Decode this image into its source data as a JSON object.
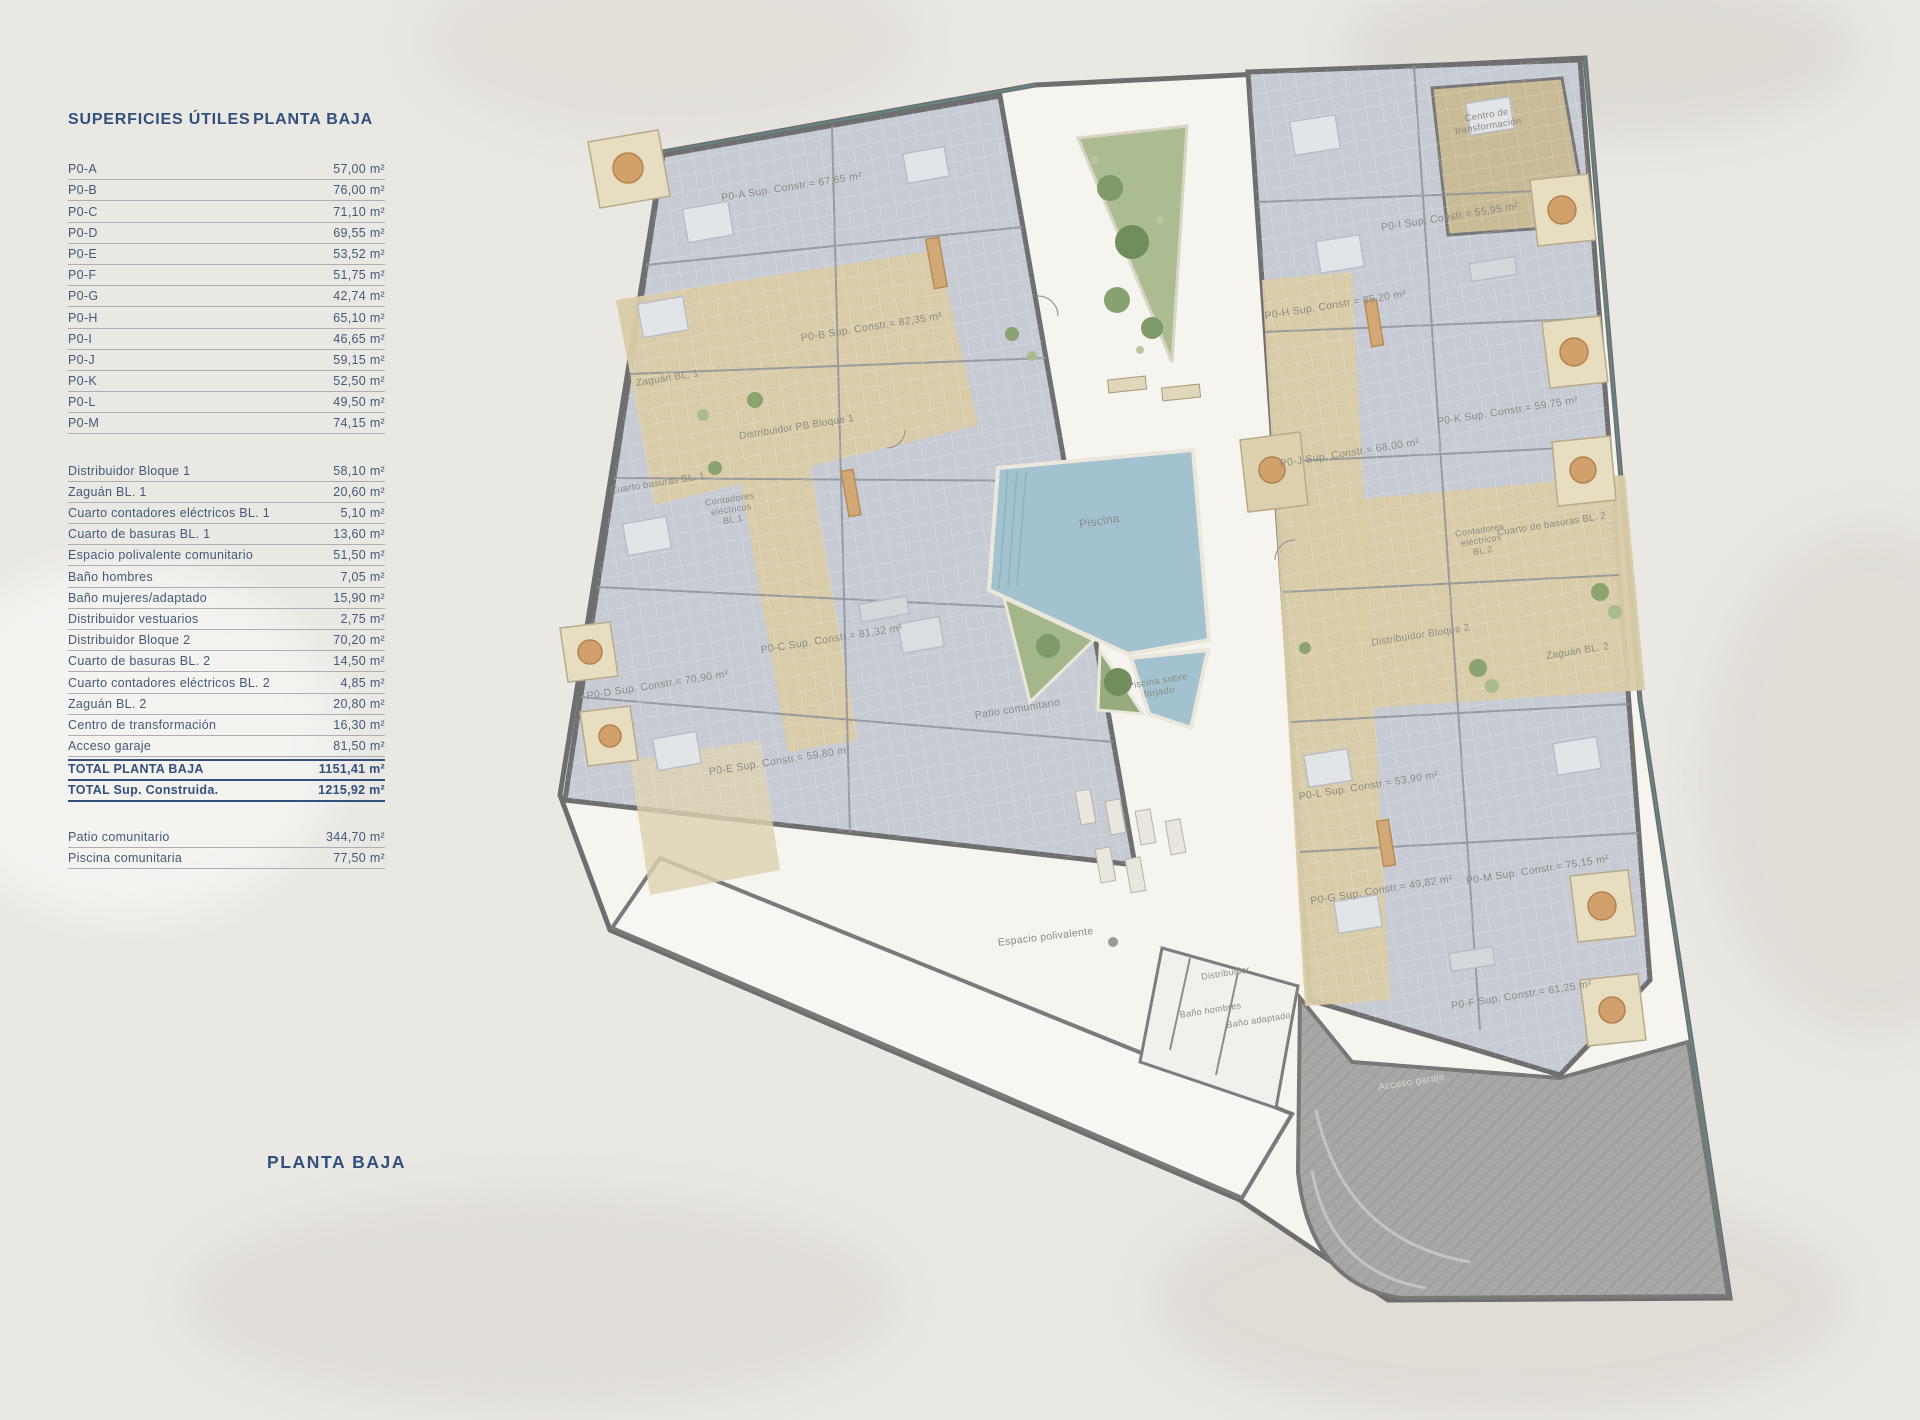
{
  "surface_table": {
    "title": "SUPERFICIES ÚTILES",
    "subtitle": "PLANTA BAJA",
    "apartments": [
      {
        "label": "P0-A",
        "value": "57,00 m²"
      },
      {
        "label": "P0-B",
        "value": "76,00 m²"
      },
      {
        "label": "P0-C",
        "value": "71,10 m²"
      },
      {
        "label": "P0-D",
        "value": "69,55 m²"
      },
      {
        "label": "P0-E",
        "value": "53,52 m²"
      },
      {
        "label": "P0-F",
        "value": "51,75 m²"
      },
      {
        "label": "P0-G",
        "value": "42,74 m²"
      },
      {
        "label": "P0-H",
        "value": "65,10 m²"
      },
      {
        "label": "P0-I",
        "value": "46,65 m²"
      },
      {
        "label": "P0-J",
        "value": "59,15 m²"
      },
      {
        "label": "P0-K",
        "value": "52,50 m²"
      },
      {
        "label": "P0-L",
        "value": "49,50 m²"
      },
      {
        "label": "P0-M",
        "value": "74,15 m²"
      }
    ],
    "common_rows": [
      {
        "label": "Distribuidor Bloque 1",
        "value": "58,10 m²"
      },
      {
        "label": "Zaguán BL. 1",
        "value": "20,60 m²"
      },
      {
        "label": "Cuarto contadores eléctricos BL. 1",
        "value": "5,10 m²"
      },
      {
        "label": "Cuarto de basuras BL. 1",
        "value": "13,60 m²"
      },
      {
        "label": "Espacio polivalente comunitario",
        "value": "51,50 m²"
      },
      {
        "label": "Baño hombres",
        "value": "7,05 m²"
      },
      {
        "label": "Baño mujeres/adaptado",
        "value": "15,90 m²"
      },
      {
        "label": "Distribuidor vestuarios",
        "value": "2,75 m²"
      },
      {
        "label": "Distribuidor Bloque 2",
        "value": "70,20 m²"
      },
      {
        "label": "Cuarto de basuras BL. 2",
        "value": "14,50 m²"
      },
      {
        "label": "Cuarto contadores eléctricos BL. 2",
        "value": "4,85 m²"
      },
      {
        "label": "Zaguán BL. 2",
        "value": "20,80 m²"
      },
      {
        "label": "Centro de transformación",
        "value": "16,30 m²"
      },
      {
        "label": "Acceso garaje",
        "value": "81,50 m²"
      }
    ],
    "total_rows": [
      {
        "label": "TOTAL PLANTA BAJA",
        "value": "1151,41 m²"
      },
      {
        "label": "TOTAL Sup. Construida.",
        "value": "1215,92 m²"
      }
    ],
    "exterior_rows": [
      {
        "label": "Patio comunitario",
        "value": "344,70 m²"
      },
      {
        "label": "Piscina comunitaria",
        "value": "77,50 m²"
      }
    ]
  },
  "footer": {
    "title": "PLANTA BAJA"
  },
  "plan": {
    "label_color": "#8b8b83",
    "labels": [
      {
        "text": "P0-A Sup. Constr.= 67,65 m²",
        "x": 792,
        "y": 190,
        "rot": -9,
        "size": 10.5
      },
      {
        "text": "P0-B Sup. Constr.= 82,35 m²",
        "x": 872,
        "y": 330,
        "rot": -9,
        "size": 10.5
      },
      {
        "text": "Zaguán BL. 1",
        "x": 668,
        "y": 381,
        "rot": -9,
        "size": 10
      },
      {
        "text": "Distribuidor PB Bloque 1",
        "x": 797,
        "y": 430,
        "rot": -9,
        "size": 10
      },
      {
        "text": "Cuarto basuras BL. 1",
        "x": 658,
        "y": 486,
        "rot": -9,
        "size": 9.5
      },
      {
        "lines": [
          "Contadores",
          "eléctricos",
          "BL.1"
        ],
        "x": 730,
        "y": 502,
        "rot": -9,
        "size": 9
      },
      {
        "text": "P0-C Sup. Constr.= 81,32 m²",
        "x": 832,
        "y": 642,
        "rot": -9,
        "size": 10.5
      },
      {
        "text": "P0-D Sup. Constr.= 70,90 m²",
        "x": 658,
        "y": 688,
        "rot": -9,
        "size": 10.5
      },
      {
        "text": "P0-E Sup. Constr.= 59,80 m²",
        "x": 780,
        "y": 764,
        "rot": -9,
        "size": 10.5
      },
      {
        "text": "Patio comunitario",
        "x": 1018,
        "y": 712,
        "rot": -9,
        "size": 10.5
      },
      {
        "text": "Piscina",
        "x": 1100,
        "y": 525,
        "rot": -9,
        "size": 12
      },
      {
        "lines": [
          "Piscina sobre",
          "forjado"
        ],
        "x": 1158,
        "y": 684,
        "rot": -9,
        "size": 9.5
      },
      {
        "text": "Espacio polivalente",
        "x": 1046,
        "y": 940,
        "rot": -7,
        "size": 10.5
      },
      {
        "text": "Distribuidor",
        "x": 1226,
        "y": 976,
        "rot": -9,
        "size": 9
      },
      {
        "text": "Baño hombres",
        "x": 1211,
        "y": 1013,
        "rot": -9,
        "size": 9
      },
      {
        "text": "Baño adaptado",
        "x": 1259,
        "y": 1023,
        "rot": -9,
        "size": 9
      },
      {
        "text": "Acceso garaje",
        "x": 1412,
        "y": 1085,
        "rot": -9,
        "size": 10,
        "fill": "#d8d6d0"
      },
      {
        "lines": [
          "Centro de",
          "transformación"
        ],
        "x": 1487,
        "y": 118,
        "rot": -9,
        "size": 9.5
      },
      {
        "text": "P0-I Sup. Constr.= 55,95 m²",
        "x": 1450,
        "y": 220,
        "rot": -9,
        "size": 10.5
      },
      {
        "text": "P0-H Sup. Constr.= 85,20 m²",
        "x": 1336,
        "y": 308,
        "rot": -9,
        "size": 10.5
      },
      {
        "text": "P0-J Sup. Constr.= 68,00 m²",
        "x": 1350,
        "y": 456,
        "rot": -9,
        "size": 10.5
      },
      {
        "text": "P0-K Sup. Constr.= 59,75 m²",
        "x": 1508,
        "y": 414,
        "rot": -9,
        "size": 10.5
      },
      {
        "text": "Cuarto de basuras BL. 2",
        "x": 1552,
        "y": 527,
        "rot": -9,
        "size": 9.5
      },
      {
        "lines": [
          "Contadores",
          "eléctricos",
          "BL.2"
        ],
        "x": 1480,
        "y": 533,
        "rot": -9,
        "size": 9
      },
      {
        "text": "Distribuidor Bloque 2",
        "x": 1421,
        "y": 638,
        "rot": -9,
        "size": 10
      },
      {
        "text": "Zaguán BL. 2",
        "x": 1578,
        "y": 654,
        "rot": -9,
        "size": 10
      },
      {
        "text": "P0-L Sup. Constr.= 53,90 m²",
        "x": 1369,
        "y": 789,
        "rot": -9,
        "size": 10.5
      },
      {
        "text": "P0-G Sup. Constr.= 49,82 m²",
        "x": 1382,
        "y": 893,
        "rot": -9,
        "size": 10.5
      },
      {
        "text": "P0-M Sup. Constr.= 75,15 m²",
        "x": 1538,
        "y": 873,
        "rot": -9,
        "size": 10.5
      },
      {
        "text": "P0-F Sup. Constr.= 61,25 m²",
        "x": 1522,
        "y": 998,
        "rot": -9,
        "size": 10.5
      }
    ]
  },
  "colors": {
    "accent_navy": "#31507d",
    "row_text": "#42597a",
    "wall_gray": "#6e6e6e",
    "room_fill": "#c7ccd4",
    "corridor_tan": "#d9cba6",
    "pool_blue": "#a2c2cf",
    "garden_green": "#aabc90",
    "garage_gray": "#a7a7a5",
    "paper": "#eae8e3",
    "courtyard": "#f5f4ef"
  }
}
